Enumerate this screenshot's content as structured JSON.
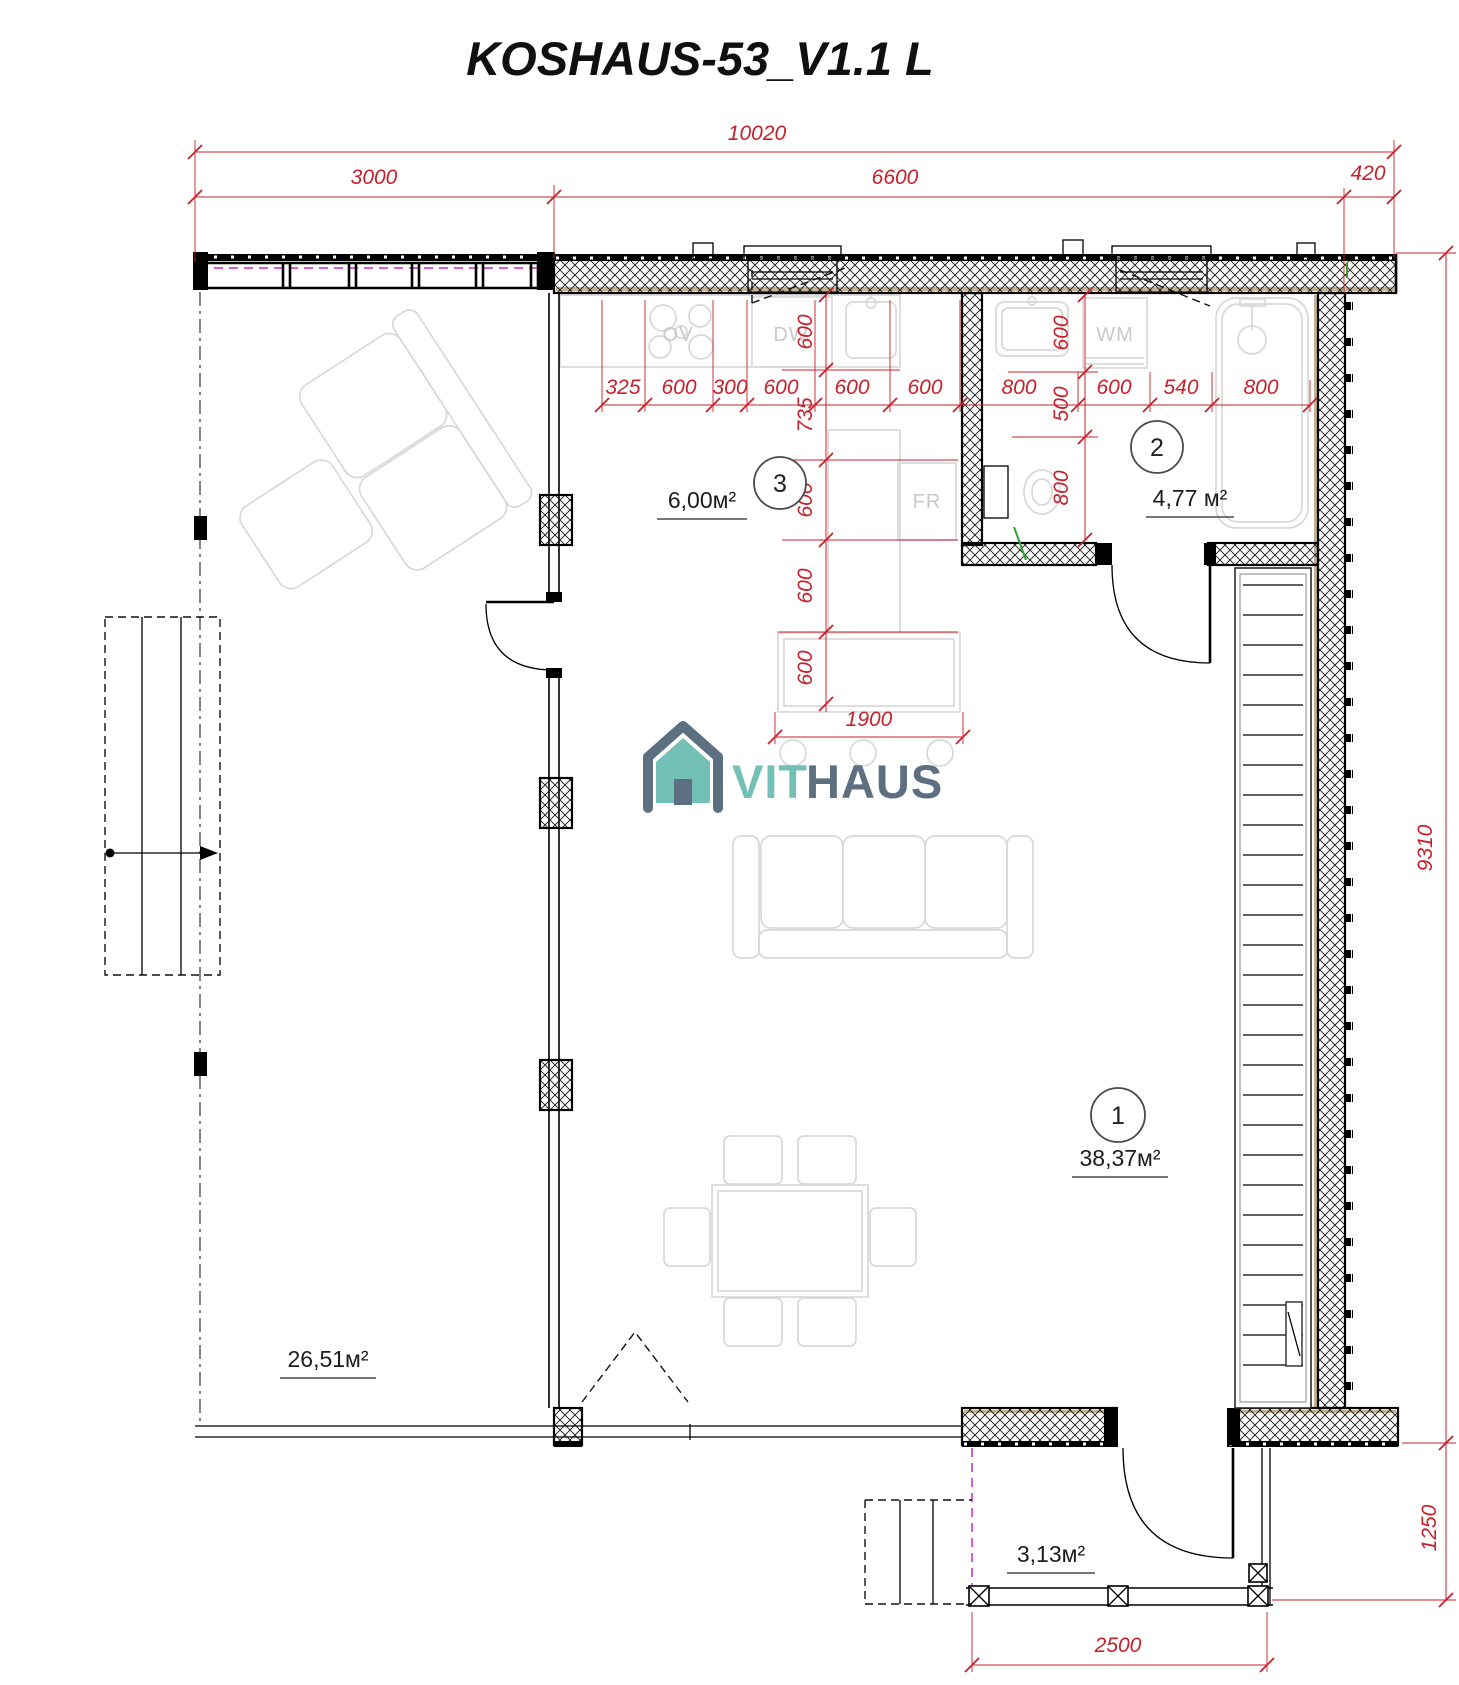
{
  "title": "KOSHAUS-53_V1.1 L",
  "logo": {
    "vit": "VIT",
    "haus": "HAUS"
  },
  "colors": {
    "dimension": "#c8202a",
    "furniture": "#d8d8d8",
    "logo_teal": "#73c0b6",
    "logo_slate": "#5c7082",
    "magenta": "#c52bc5",
    "lining": "#c3b193",
    "green": "#2ca02c"
  },
  "rooms": {
    "living": {
      "number": "1",
      "area": "38,37м²"
    },
    "bathroom": {
      "number": "2",
      "area": "4,77 м²"
    },
    "kitchen": {
      "number": "3",
      "area": "6,00м²"
    },
    "terrace": {
      "area": "26,51м²"
    },
    "porch": {
      "area": "3,13м²"
    }
  },
  "appliances": {
    "oven": "OV",
    "dishwasher": "DW",
    "washing_machine": "WM",
    "fridge": "FR"
  },
  "dimensions": {
    "overall": "10020",
    "top_segments": [
      "3000",
      "6600",
      "420"
    ],
    "horizontal_chain": [
      "325",
      "600",
      "300",
      "600",
      "600",
      "600",
      "800",
      "600",
      "540",
      "800"
    ],
    "kitchen_vertical_chain": [
      "600",
      "735",
      "600",
      "600",
      "600"
    ],
    "bath_vertical_chain": [
      "600",
      "500",
      "800"
    ],
    "island_width": "1900",
    "east_height": "9310",
    "porch_height": "1250",
    "porch_width": "2500"
  }
}
